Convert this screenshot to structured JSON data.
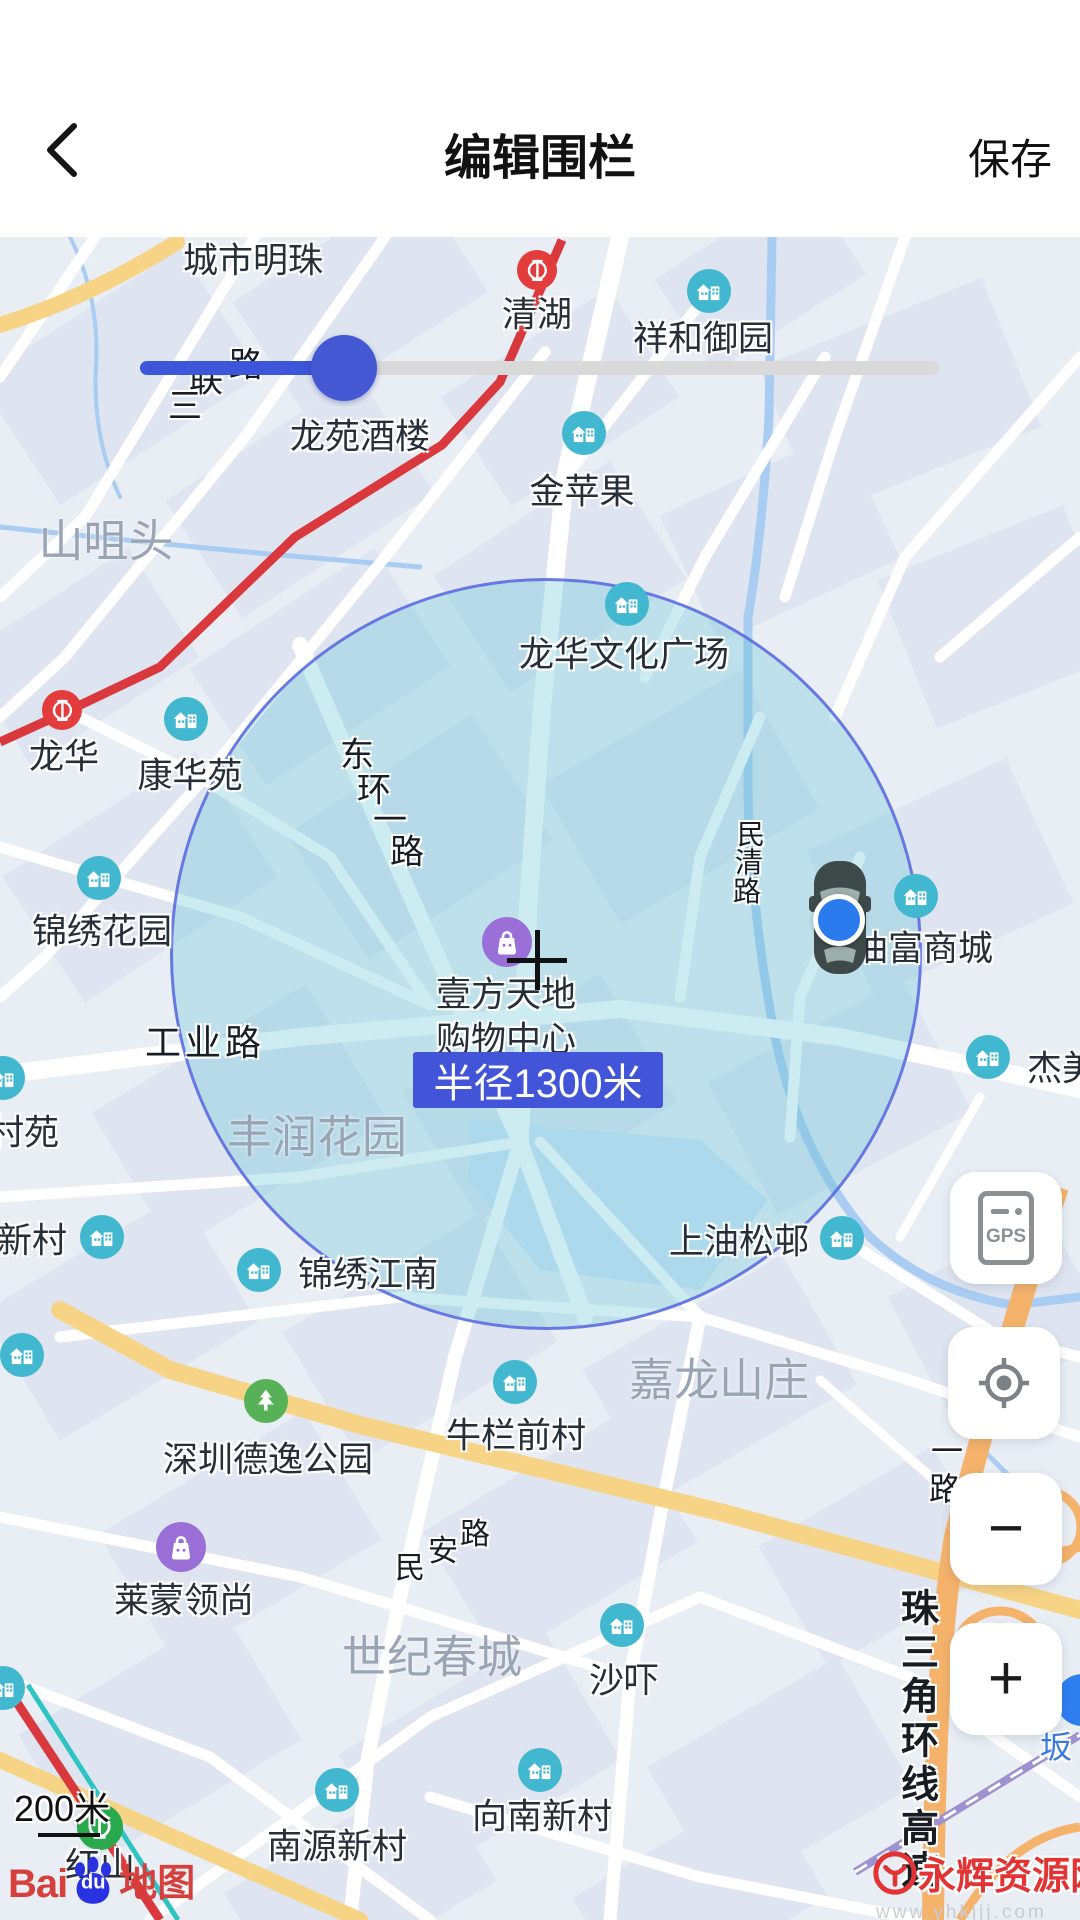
{
  "header": {
    "title": "编辑围栏",
    "save": "保存"
  },
  "fence": {
    "radius_label": "半径1300米"
  },
  "controls": {
    "gps": "GPS",
    "zoom_out": "−",
    "zoom_in": "+"
  },
  "scale": {
    "label": "200米"
  },
  "brand": {
    "bai": "Bai",
    "du": "du",
    "suffix": "地图"
  },
  "watermark": {
    "name": "永辉资源网",
    "url": "www.yhkjjj.com"
  },
  "map": {
    "pois": [
      {
        "label": "城市明珠",
        "lx": 253,
        "ly": 21
      },
      {
        "label": "清湖",
        "lx": 537,
        "ly": 75,
        "type": "metro",
        "ix": 537,
        "iy": 33
      },
      {
        "label": "祥和御园",
        "lx": 703,
        "ly": 99,
        "type": "building",
        "ix": 709,
        "iy": 54
      },
      {
        "label": "龙苑酒楼",
        "lx": 360,
        "ly": 197
      },
      {
        "label": "金苹果",
        "lx": 582,
        "ly": 252,
        "type": "building",
        "ix": 584,
        "iy": 196
      },
      {
        "label": "龙华文化广场",
        "lx": 624,
        "ly": 415,
        "type": "building",
        "ix": 627,
        "iy": 367
      },
      {
        "label": "龙华",
        "lx": 64,
        "ly": 517,
        "type": "metro",
        "ix": 62,
        "iy": 473
      },
      {
        "label": "康华苑",
        "lx": 190,
        "ly": 536,
        "type": "building",
        "ix": 186,
        "iy": 482
      },
      {
        "label": "锦绣花园",
        "lx": 102,
        "ly": 692,
        "type": "building",
        "ix": 99,
        "iy": 641
      },
      {
        "label": "壹方天地",
        "lx": 506,
        "ly": 755,
        "type": "mall",
        "ix": 507,
        "iy": 705
      },
      {
        "label": "购物中心",
        "lx": 506,
        "ly": 800
      },
      {
        "label": "油富商城",
        "lx": 923,
        "ly": 709,
        "type": "building",
        "ix": 916,
        "iy": 659
      },
      {
        "label": "杰美",
        "lx": 1062,
        "ly": 829,
        "type": "building",
        "ix": 988,
        "iy": 820
      },
      {
        "label": "村苑",
        "lx": 24,
        "ly": 893,
        "type": "building",
        "ix": 3,
        "iy": 841
      },
      {
        "label": "新村",
        "lx": 32,
        "ly": 1001,
        "type": "building",
        "ix": 102,
        "iy": 1000
      },
      {
        "label": "锦绣江南",
        "lx": 368,
        "ly": 1035,
        "type": "building",
        "ix": 259,
        "iy": 1033
      },
      {
        "label": "上油松邨",
        "lx": 739,
        "ly": 1002,
        "type": "building",
        "ix": 842,
        "iy": 1001
      },
      {
        "label": "牛栏前村",
        "lx": 516,
        "ly": 1196,
        "type": "building",
        "ix": 515,
        "iy": 1145
      },
      {
        "label": "深圳德逸公园",
        "lx": 268,
        "ly": 1220,
        "type": "park",
        "ix": 266,
        "iy": 1164
      },
      {
        "label": "莱蒙领尚",
        "lx": 184,
        "ly": 1361,
        "type": "mall",
        "ix": 181,
        "iy": 1310
      },
      {
        "label": "沙吓",
        "lx": 624,
        "ly": 1441,
        "type": "building",
        "ix": 622,
        "iy": 1388
      },
      {
        "label": "南源新村",
        "lx": 337,
        "ly": 1607,
        "type": "building",
        "ix": 337,
        "iy": 1553
      },
      {
        "label": "向南新村",
        "lx": 542,
        "ly": 1577,
        "type": "building",
        "ix": 540,
        "iy": 1533
      },
      {
        "label": "红山",
        "lx": 100,
        "ly": 1626,
        "type": "metro-green",
        "ix": 100,
        "iy": 1590
      },
      {
        "type": "building",
        "ix": 22,
        "iy": 1118
      },
      {
        "type": "building",
        "ix": 3,
        "iy": 1451
      }
    ],
    "areas": [
      {
        "name": "山咀头",
        "x": 106,
        "y": 300
      },
      {
        "name": "丰润花园",
        "x": 317,
        "y": 896
      },
      {
        "name": "嘉龙山庄",
        "x": 719,
        "y": 1139
      },
      {
        "name": "世纪春城",
        "x": 432,
        "y": 1416
      }
    ],
    "roads": [
      {
        "name": "三联路",
        "size": 34,
        "chars": [
          [
            "三",
            185,
            166
          ],
          [
            "联",
            206,
            140
          ],
          [
            "路",
            246,
            125
          ]
        ]
      },
      {
        "name": "东环一路",
        "size": 34,
        "chars": [
          [
            "东",
            357,
            515
          ],
          [
            "环",
            374,
            550
          ],
          [
            "一",
            390,
            580
          ],
          [
            "路",
            407,
            612
          ]
        ]
      },
      {
        "name": "民清路",
        "size": 28,
        "chars": [
          [
            "民",
            751,
            596
          ],
          [
            "清",
            749,
            624
          ],
          [
            "路",
            747,
            653
          ]
        ]
      },
      {
        "name": "工业路",
        "size": 36,
        "chars": [
          [
            "工",
            163,
            803
          ],
          [
            "业",
            203,
            803
          ],
          [
            "路",
            243,
            803
          ]
        ]
      },
      {
        "name": "民安路",
        "size": 30,
        "chars": [
          [
            "民",
            410,
            1328
          ],
          [
            "安",
            443,
            1311
          ],
          [
            "路",
            475,
            1294
          ]
        ]
      },
      {
        "name": "一路",
        "size": 32,
        "chars": [
          [
            "一",
            947,
            1212
          ],
          [
            "路",
            945,
            1250
          ]
        ]
      },
      {
        "name": "珠三角环线高速",
        "size": 38,
        "weight": 700,
        "chars": [
          [
            "珠",
            920,
            1368
          ],
          [
            "三",
            920,
            1412
          ],
          [
            "角",
            920,
            1456
          ],
          [
            "环",
            920,
            1500
          ],
          [
            "线",
            920,
            1544
          ],
          [
            "高",
            920,
            1588
          ],
          [
            "速",
            920,
            1630
          ]
        ]
      },
      {
        "name": "坂",
        "size": 32,
        "color": "#3a7bdb",
        "chars": [
          [
            "坂",
            1056,
            1508
          ]
        ]
      }
    ]
  }
}
